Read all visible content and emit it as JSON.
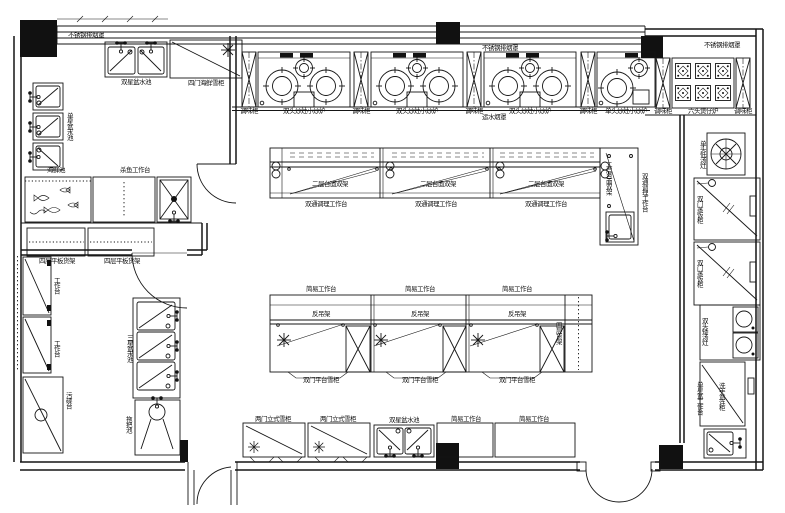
{
  "drawing": {
    "type": "commercial-kitchen-floor-plan",
    "canvas": {
      "width": 785,
      "height": 513,
      "background": "#ffffff",
      "line_color": "#151515"
    },
    "icons": {
      "snowflake-icon": "refrigeration symbol ✳",
      "faucet-icon": "tap with two handles",
      "burner-icon": "concentric circles wok burner",
      "door-swing-icon": "quarter-circle arc"
    }
  },
  "floorplan": {
    "labels": [
      {
        "id": "label-hood-left",
        "text": "不锈钢排烟罩",
        "x": 86,
        "y": 35,
        "o": "h"
      },
      {
        "id": "label-hood-mid",
        "text": "不锈钢排烟罩",
        "x": 500,
        "y": 48,
        "o": "h"
      },
      {
        "id": "label-hood-right",
        "text": "不锈钢排烟罩",
        "x": 722,
        "y": 45,
        "o": "h"
      },
      {
        "id": "label-water-hood",
        "text": "运水烟罩",
        "x": 494,
        "y": 117,
        "o": "h"
      },
      {
        "id": "label-double-sink-topleft",
        "text": "双星盆水池",
        "x": 136,
        "y": 82,
        "o": "h"
      },
      {
        "id": "label-fridge-topleft",
        "text": "四门海鲜雪柜",
        "x": 206,
        "y": 83,
        "o": "h"
      },
      {
        "id": "label-spice-cab-1",
        "text": "调味柜",
        "x": 249,
        "y": 111,
        "o": "h"
      },
      {
        "id": "label-wok-stove-1",
        "text": "双头炒灶小炒炉",
        "x": 304,
        "y": 111,
        "o": "h"
      },
      {
        "id": "label-spice-cab-2",
        "text": "调味柜",
        "x": 361,
        "y": 111,
        "o": "h"
      },
      {
        "id": "label-wok-stove-2",
        "text": "双头炒灶小炒炉",
        "x": 417,
        "y": 111,
        "o": "h"
      },
      {
        "id": "label-spice-cab-3",
        "text": "调味柜",
        "x": 474,
        "y": 111,
        "o": "h"
      },
      {
        "id": "label-wok-stove-3",
        "text": "双头炒灶小炒炉",
        "x": 530,
        "y": 111,
        "o": "h"
      },
      {
        "id": "label-spice-cab-4",
        "text": "调味柜",
        "x": 588,
        "y": 111,
        "o": "h"
      },
      {
        "id": "label-wok-stove-4",
        "text": "单头炒灶小炒炉",
        "x": 626,
        "y": 111,
        "o": "h"
      },
      {
        "id": "label-spice-cab-5",
        "text": "调味柜",
        "x": 663,
        "y": 111,
        "o": "h"
      },
      {
        "id": "label-claypot-stove",
        "text": "六头煲仔炉",
        "x": 703,
        "y": 111,
        "o": "h"
      },
      {
        "id": "label-spice-cab-6",
        "text": "调味柜",
        "x": 743,
        "y": 111,
        "o": "h"
      },
      {
        "id": "label-single-sinks-left",
        "text": "单星盆水池",
        "x": 69,
        "y": 126,
        "o": "v"
      },
      {
        "id": "label-seafood-tank",
        "text": "海鲜池",
        "x": 56,
        "y": 170,
        "o": "h"
      },
      {
        "id": "label-fish-table",
        "text": "杀鱼工作台",
        "x": 135,
        "y": 170,
        "o": "h"
      },
      {
        "id": "label-shelf-rack-1",
        "text": "四层平板货架",
        "x": 57,
        "y": 261,
        "o": "h"
      },
      {
        "id": "label-shelf-rack-2",
        "text": "四层平板货架",
        "x": 122,
        "y": 261,
        "o": "h"
      },
      {
        "id": "label-worktable-left-1",
        "text": "工作台",
        "x": 56,
        "y": 285,
        "o": "v"
      },
      {
        "id": "label-worktable-left-2",
        "text": "工作台",
        "x": 56,
        "y": 348,
        "o": "v"
      },
      {
        "id": "label-dish-table-left",
        "text": "污碟台",
        "x": 68,
        "y": 400,
        "o": "v"
      },
      {
        "id": "label-triple-sink",
        "text": "三星盆水池",
        "x": 129,
        "y": 348,
        "o": "v"
      },
      {
        "id": "label-mop-sink",
        "text": "拖把池",
        "x": 128,
        "y": 424,
        "o": "v"
      },
      {
        "id": "label-shelf-tier-1",
        "text": "二层台面双架",
        "x": 330,
        "y": 184,
        "o": "h"
      },
      {
        "id": "label-shelf-tier-2",
        "text": "二层台面双架",
        "x": 438,
        "y": 184,
        "o": "h"
      },
      {
        "id": "label-shelf-tier-3",
        "text": "二层台面双架",
        "x": 546,
        "y": 184,
        "o": "h"
      },
      {
        "id": "label-prep-table-1",
        "text": "双通调理工作台",
        "x": 326,
        "y": 204,
        "o": "h"
      },
      {
        "id": "label-prep-table-2",
        "text": "双通调理工作台",
        "x": 436,
        "y": 204,
        "o": "h"
      },
      {
        "id": "label-prep-table-3",
        "text": "双通调理工作台",
        "x": 546,
        "y": 204,
        "o": "h"
      },
      {
        "id": "label-shelf-tier-4",
        "text": "二层台面双架",
        "x": 608,
        "y": 178,
        "o": "v"
      },
      {
        "id": "label-prep-table-4",
        "text": "双通调理工作台",
        "x": 644,
        "y": 192,
        "o": "v"
      },
      {
        "id": "label-simple-table-1",
        "text": "简易工作台",
        "x": 321,
        "y": 289,
        "o": "h"
      },
      {
        "id": "label-simple-table-2",
        "text": "简易工作台",
        "x": 420,
        "y": 289,
        "o": "h"
      },
      {
        "id": "label-simple-table-3",
        "text": "简易工作台",
        "x": 517,
        "y": 289,
        "o": "h"
      },
      {
        "id": "label-hang-rack-1",
        "text": "反吊架",
        "x": 321,
        "y": 314,
        "o": "h"
      },
      {
        "id": "label-hang-rack-2",
        "text": "反吊架",
        "x": 420,
        "y": 314,
        "o": "h"
      },
      {
        "id": "label-hang-rack-3",
        "text": "反吊架",
        "x": 517,
        "y": 314,
        "o": "h"
      },
      {
        "id": "label-counter-fridge-1",
        "text": "双门平台雪柜",
        "x": 321,
        "y": 380,
        "o": "h"
      },
      {
        "id": "label-counter-fridge-2",
        "text": "双门平台雪柜",
        "x": 420,
        "y": 380,
        "o": "h"
      },
      {
        "id": "label-counter-fridge-3",
        "text": "双门平台雪柜",
        "x": 517,
        "y": 380,
        "o": "h"
      },
      {
        "id": "label-rack-island2",
        "text": "四层货架",
        "x": 558,
        "y": 333,
        "o": "v"
      },
      {
        "id": "label-upright-fridge-1",
        "text": "两门立式雪柜",
        "x": 273,
        "y": 419,
        "o": "h"
      },
      {
        "id": "label-upright-fridge-2",
        "text": "两门立式雪柜",
        "x": 338,
        "y": 419,
        "o": "h"
      },
      {
        "id": "label-double-sink-bottom",
        "text": "双星盆水池",
        "x": 404,
        "y": 420,
        "o": "h"
      },
      {
        "id": "label-simple-table-4",
        "text": "简易工作台",
        "x": 466,
        "y": 419,
        "o": "h"
      },
      {
        "id": "label-simple-table-5",
        "text": "简易工作台",
        "x": 534,
        "y": 419,
        "o": "h"
      },
      {
        "id": "label-soup-stove",
        "text": "单头低汤灶",
        "x": 702,
        "y": 154,
        "o": "v"
      },
      {
        "id": "label-rice-steamer-1",
        "text": "双门蒸饭柜",
        "x": 699,
        "y": 209,
        "o": "v"
      },
      {
        "id": "label-rice-steamer-2",
        "text": "双门蒸饭柜",
        "x": 699,
        "y": 273,
        "o": "v"
      },
      {
        "id": "label-low-soup-stove",
        "text": "双头矮汤灶",
        "x": 704,
        "y": 331,
        "o": "v"
      },
      {
        "id": "label-sink-worktable-right",
        "text": "单星盆工作台",
        "x": 699,
        "y": 398,
        "o": "v"
      },
      {
        "id": "label-hand-sink",
        "text": "洗手盆连柜",
        "x": 721,
        "y": 396,
        "o": "v"
      }
    ]
  }
}
